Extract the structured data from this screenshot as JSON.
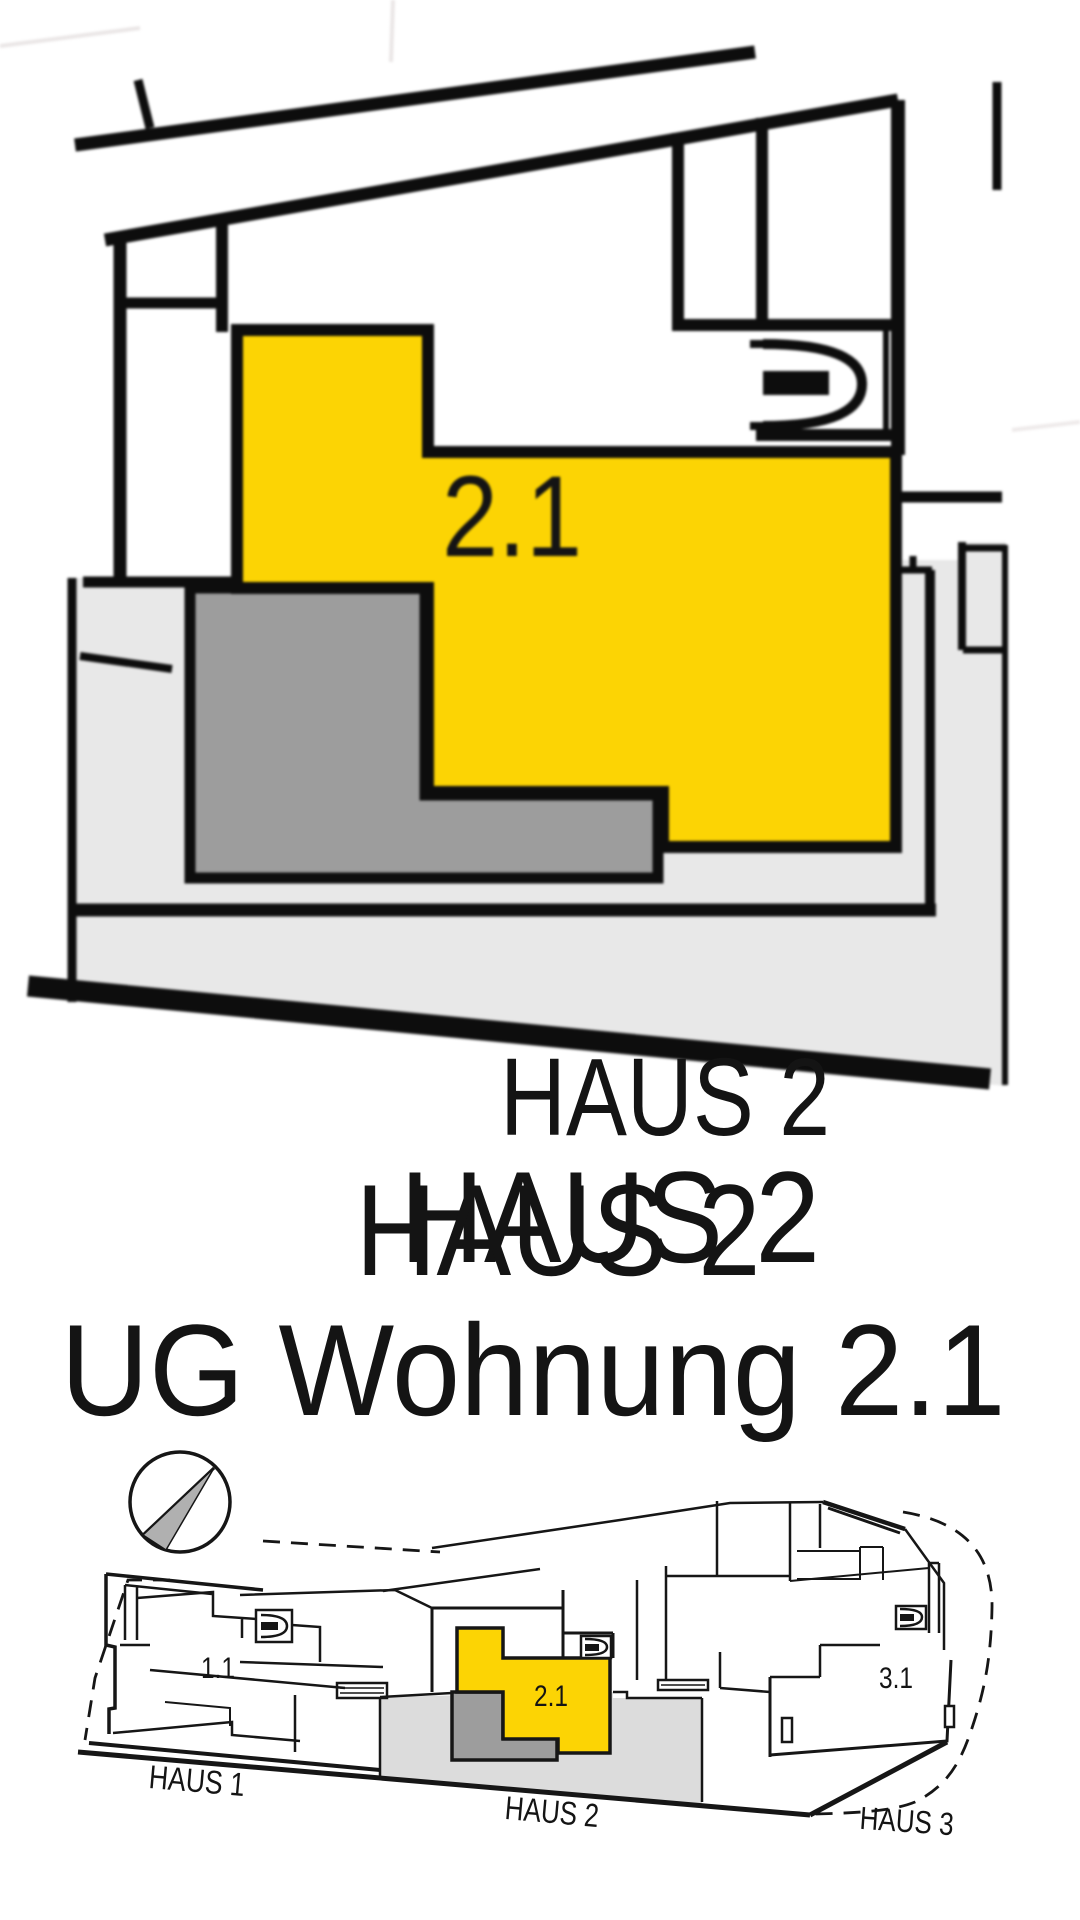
{
  "colors": {
    "highlight": "#fcd404",
    "terrace_gray": "#9d9d9d",
    "ground_gray": "#e8e8e8",
    "walkway_gray": "#dcdcdc",
    "line_black": "#0d0d0d",
    "faint_watermark": "#f2f0f1",
    "compass_wedge": "#b0b0b0",
    "title_black": "#1c1c1c"
  },
  "detail_plan": {
    "unit_label": "2.1"
  },
  "watermark": {
    "line1": "HAUS 2",
    "line2": "HAUS 2"
  },
  "title": {
    "line1": "HAUS 2",
    "line2": "UG Wohnung 2.1"
  },
  "site_plan": {
    "units": [
      {
        "label": "1.1"
      },
      {
        "label": "2.1"
      },
      {
        "label": "3.1"
      }
    ],
    "houses": [
      {
        "label": "HAUS 1"
      },
      {
        "label": "HAUS 2"
      },
      {
        "label": "HAUS 3"
      }
    ]
  }
}
